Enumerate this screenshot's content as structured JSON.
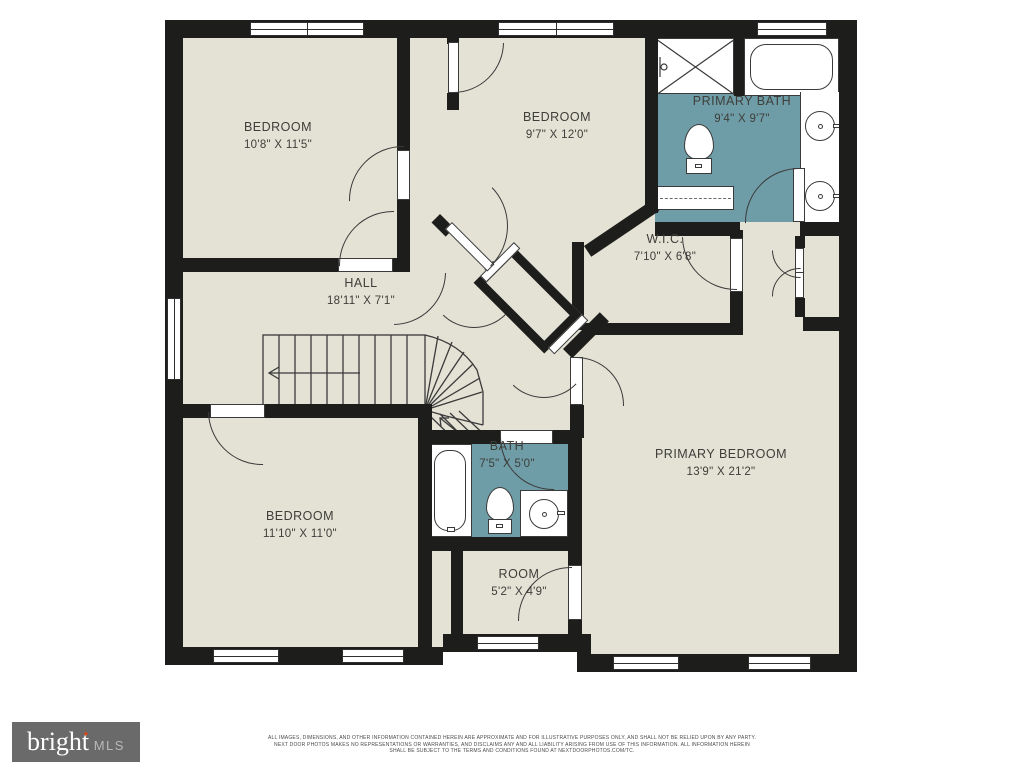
{
  "title": "Second floor residential floor plan",
  "rooms": [
    {
      "name": "BEDROOM",
      "dims": "10'8\" X 11'5\""
    },
    {
      "name": "BEDROOM",
      "dims": "9'7\" X 12'0\""
    },
    {
      "name": "PRIMARY BATH",
      "dims": "9'4\" X 9'7\""
    },
    {
      "name": "W.I.C.",
      "dims": "7'10\" X 6'8\""
    },
    {
      "name": "HALL",
      "dims": "18'11\" X 7'1\""
    },
    {
      "name": "BEDROOM",
      "dims": "11'10\" X 11'0\""
    },
    {
      "name": "BATH",
      "dims": "7'5\" X 5'0\""
    },
    {
      "name": "PRIMARY BEDROOM",
      "dims": "13'9\" X 21'2\""
    },
    {
      "name": "ROOM",
      "dims": "5'2\" X 4'9\""
    }
  ],
  "branding": {
    "logo_text": "bright",
    "logo_star": "✦",
    "logo_suffix": "MLS"
  },
  "disclaimer": {
    "line1": "ALL IMAGES, DIMENSIONS, AND OTHER INFORMATION CONTAINED HEREIN ARE APPROXIMATE AND FOR ILLUSTRATIVE PURPOSES ONLY, AND SHALL NOT BE RELIED UPON BY ANY PARTY.",
    "line2": "NEXT DOOR PHOTOS MAKES NO REPRESENTATIONS OR WARRANTIES, AND DISCLAIMS ANY AND ALL LIABILITY ARISING FROM USE OF THIS INFORMATION. ALL INFORMATION HEREIN",
    "line3": "SHALL BE SUBJECT TO THE TERMS AND CONDITIONS FOUND AT NEXTDOORPHOTOS.COM/TC."
  },
  "colors": {
    "wall": "#1d1d1b",
    "floor": "#e4e2d5",
    "bath_floor": "#6f9da7",
    "logo_bg": "#6a6a6a",
    "logo_star": "#d2491d"
  }
}
